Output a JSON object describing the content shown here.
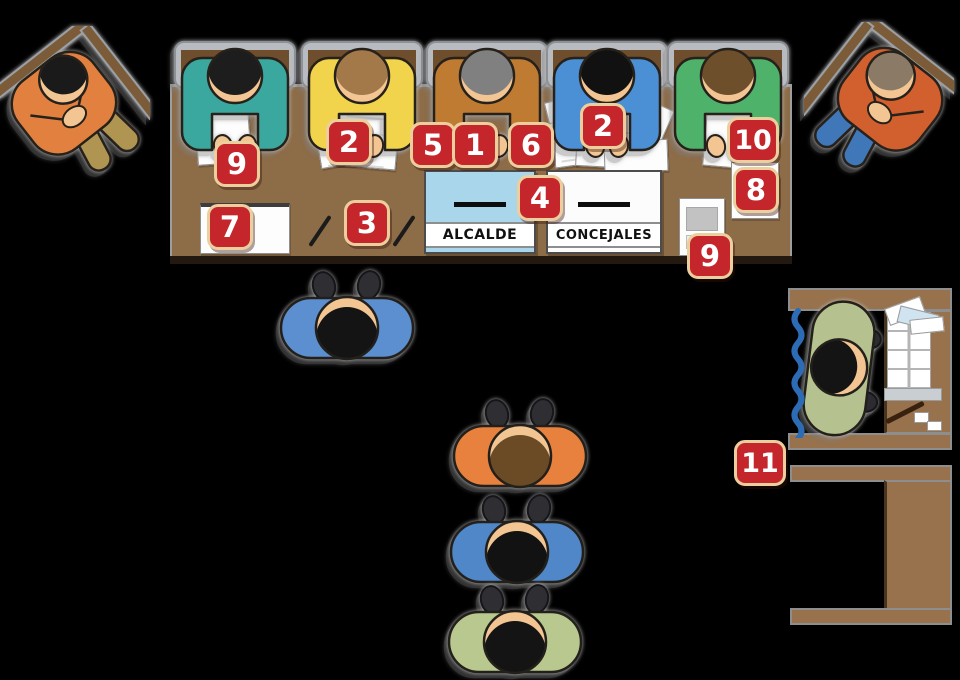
{
  "scene": {
    "description": "Top-down illustrated diagram of a polling station: officials seated at a table with numbered callouts, two ballot boxes, voters waiting in line, and a voting booth with ballot shelf."
  },
  "palette": {
    "background": "#000000",
    "badge_red": "#c5262c",
    "badge_border": "#eccf9d",
    "table_brown": "#8d6c48",
    "booth_brown": "#97724c",
    "table_edge_dark": "#231910",
    "curtain_blue": "#2d6cb5",
    "skin": "#f3c593",
    "alcalde_box_blue": "#aad6ec",
    "concejales_box_white": "#fcfcfc"
  },
  "callouts": [
    {
      "label": "9"
    },
    {
      "label": "2"
    },
    {
      "label": "5"
    },
    {
      "label": "1"
    },
    {
      "label": "6"
    },
    {
      "label": "2"
    },
    {
      "label": "10"
    },
    {
      "label": "8"
    },
    {
      "label": "7"
    },
    {
      "label": "3"
    },
    {
      "label": "4"
    },
    {
      "label": "9"
    },
    {
      "label": "11"
    }
  ],
  "ballot_boxes": {
    "alcalde_label": "ALCALDE",
    "concejales_label": "CONCEJALES"
  },
  "people": {
    "seated_members": [
      {
        "shirt": "#3aa89f",
        "hair": "#1d1d1d"
      },
      {
        "shirt": "#f2d44c",
        "hair": "#a3794a"
      },
      {
        "shirt": "#bf7b32",
        "hair": "#808080"
      },
      {
        "shirt": "#4b8fd5",
        "hair": "#111111"
      },
      {
        "shirt": "#4fb26b",
        "hair": "#6e4f2c"
      }
    ],
    "end_observers": [
      {
        "shirt": "#e2813f",
        "hair": "#1a1a1a",
        "pants": "#b09552"
      },
      {
        "shirt": "#d2602f",
        "hair": "#8a7a66",
        "pants": "#3f77b8"
      }
    ],
    "queue": [
      {
        "shirt": "#5b8fd0",
        "hair": "#141414"
      },
      {
        "shirt": "#e8813e",
        "hair": "#6b4a26"
      },
      {
        "shirt": "#4f87c9",
        "hair": "#121212"
      },
      {
        "shirt": "#b9c88e",
        "hair": "#141414"
      }
    ],
    "booth_voter": {
      "shirt": "#b5c28f",
      "hair": "#141414"
    }
  }
}
